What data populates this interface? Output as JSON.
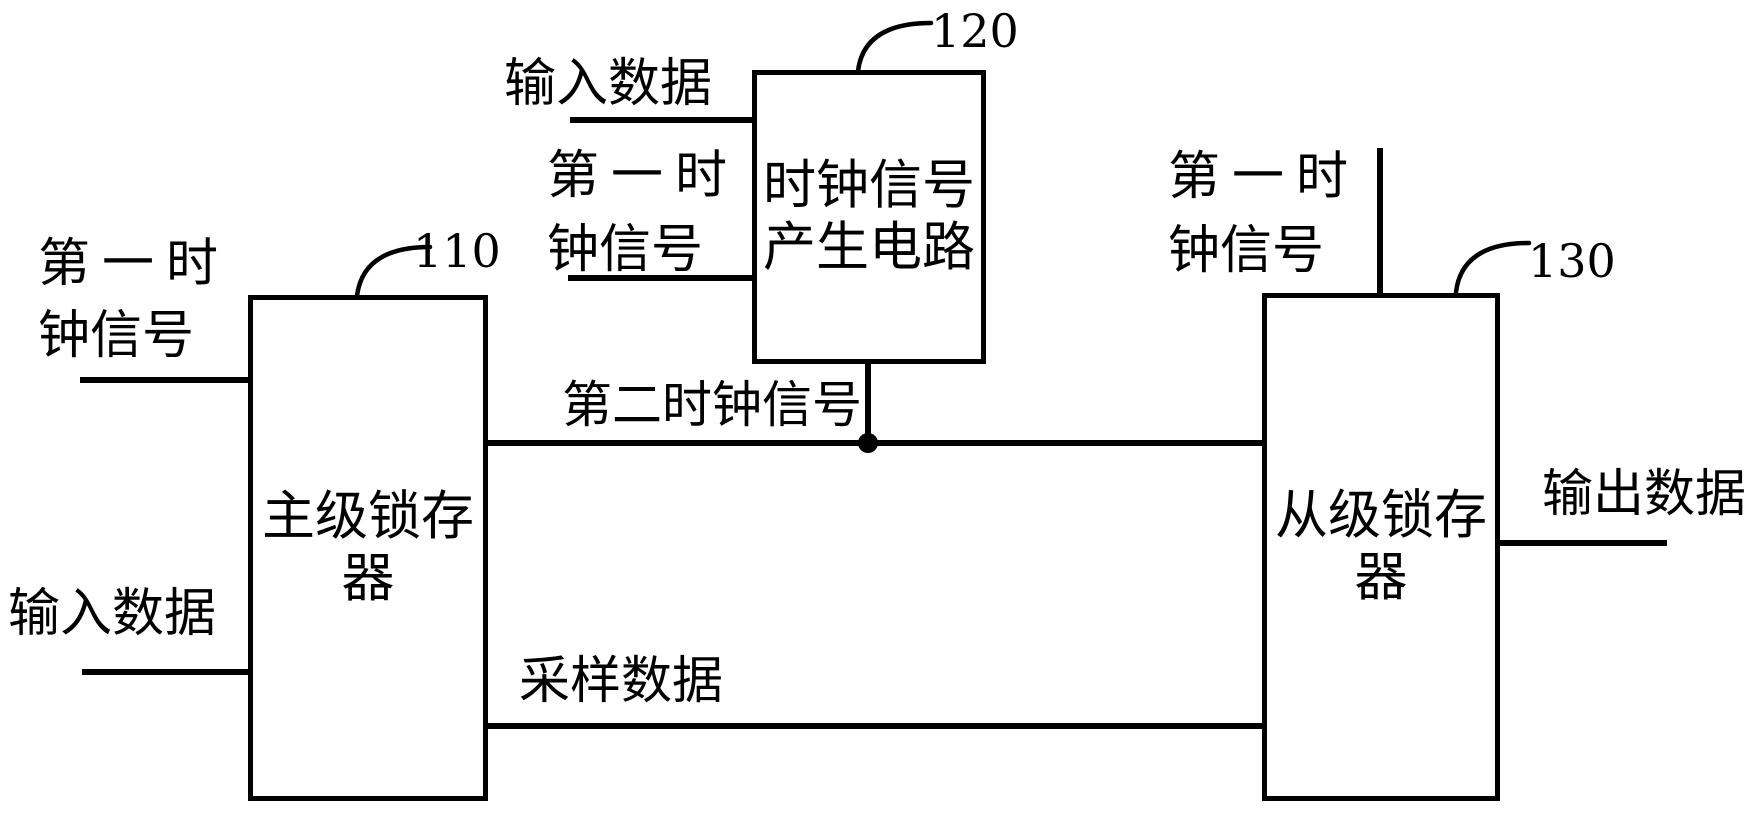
{
  "figure": {
    "background_color": "#ffffff",
    "ink_color": "#000000",
    "blocks": {
      "master_latch": {
        "ref": "110",
        "line1": "主级锁存",
        "line2": "器"
      },
      "clock_gen": {
        "ref": "120",
        "line1": "时钟信号",
        "line2": "产生电路"
      },
      "slave_latch": {
        "ref": "130",
        "line1": "从级锁存",
        "line2": "器"
      }
    },
    "signals": {
      "input_data": "输入数据",
      "first_clock_line1": "第一时",
      "first_clock_line2": "钟信号",
      "second_clock": "第二时钟信号",
      "sampled_data": "采样数据",
      "output_data": "输出数据"
    }
  }
}
